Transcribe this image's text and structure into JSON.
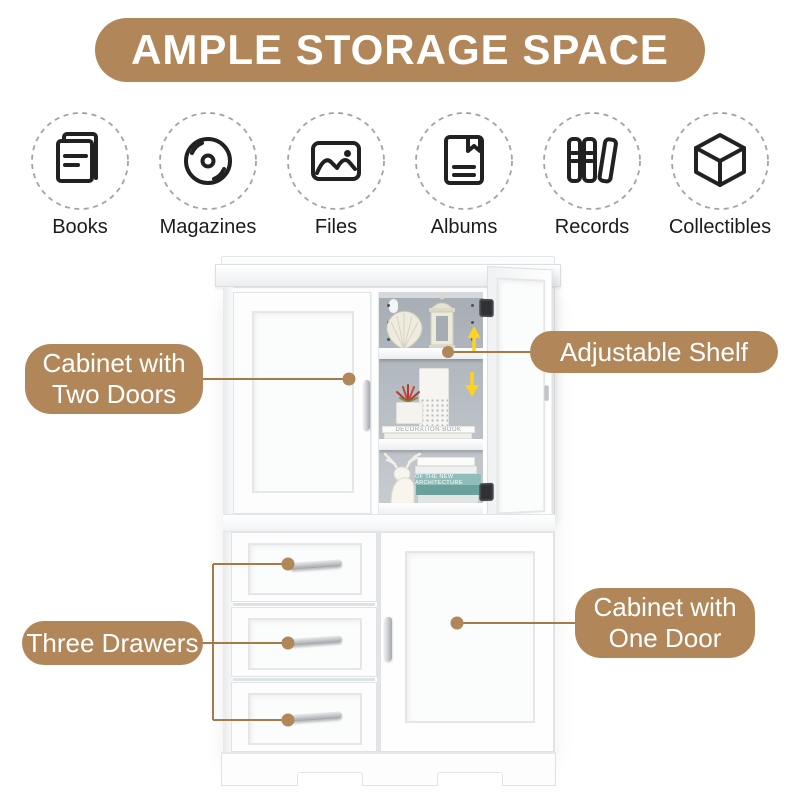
{
  "banner": {
    "title": "AMPLE STORAGE SPACE"
  },
  "categories": [
    {
      "label": "Books",
      "icon": "book-icon"
    },
    {
      "label": "Magazines",
      "icon": "disc-icon"
    },
    {
      "label": "Files",
      "icon": "photo-icon"
    },
    {
      "label": "Albums",
      "icon": "album-icon"
    },
    {
      "label": "Records",
      "icon": "binders-icon"
    },
    {
      "label": "Collectibles",
      "icon": "cube-icon"
    }
  ],
  "callouts": {
    "two_doors": {
      "label": "Cabinet with Two Doors"
    },
    "adjustable_shelf": {
      "label": "Adjustable Shelf"
    },
    "three_drawers": {
      "label": "Three Drawers"
    },
    "one_door": {
      "label": "Cabinet with One Door"
    }
  },
  "decor": {
    "book_top_title": "DECORATION BOOK",
    "book_bottom_title": "OF THE NEW ARCHITECTURE"
  },
  "colors": {
    "accent": "#B1875A",
    "connector_line": "#A57A45",
    "arrow_yellow": "#FFD21E"
  }
}
